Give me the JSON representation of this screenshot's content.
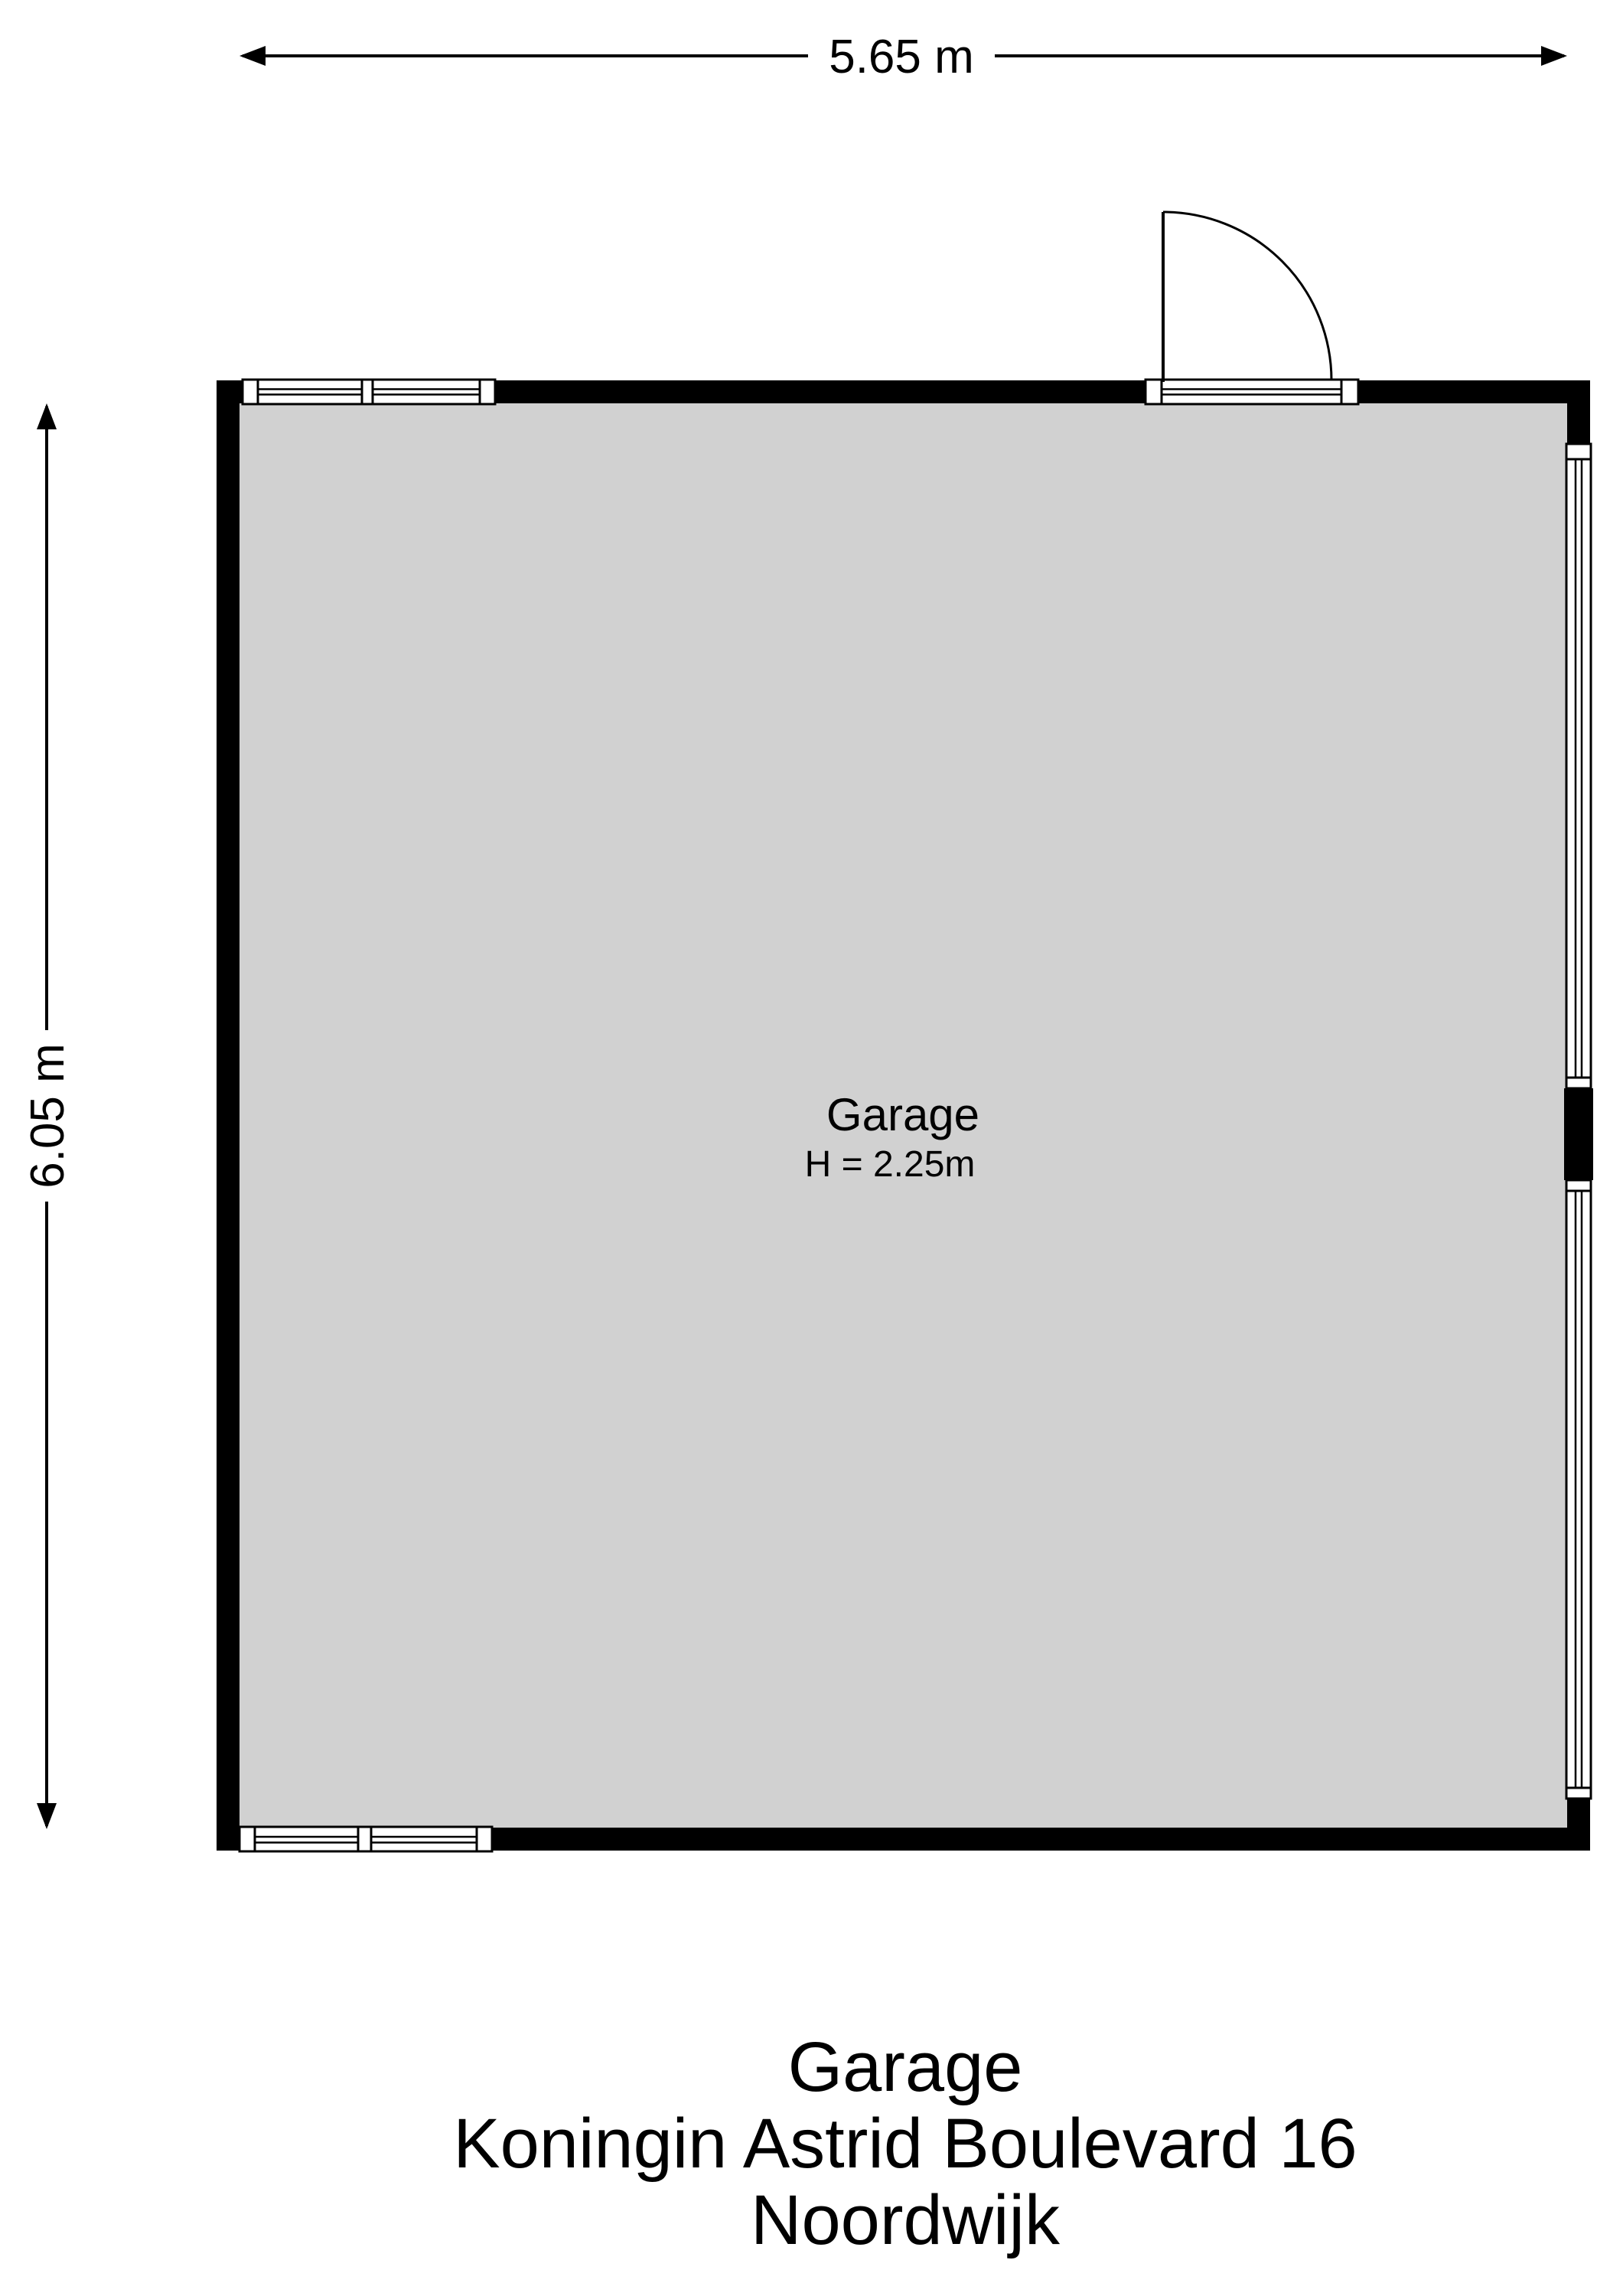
{
  "dimensions": {
    "width_label": "5.65 m",
    "height_label": "6.05 m"
  },
  "room": {
    "name": "Garage",
    "ceiling_height": "H = 2.25m"
  },
  "footer": {
    "title": "Garage",
    "address": "Koningin Astrid Boulevard 16",
    "city": "Noordwijk"
  },
  "colors": {
    "floor": "#d1d1d1",
    "wall": "#000000",
    "line": "#000000",
    "background": "#ffffff"
  }
}
